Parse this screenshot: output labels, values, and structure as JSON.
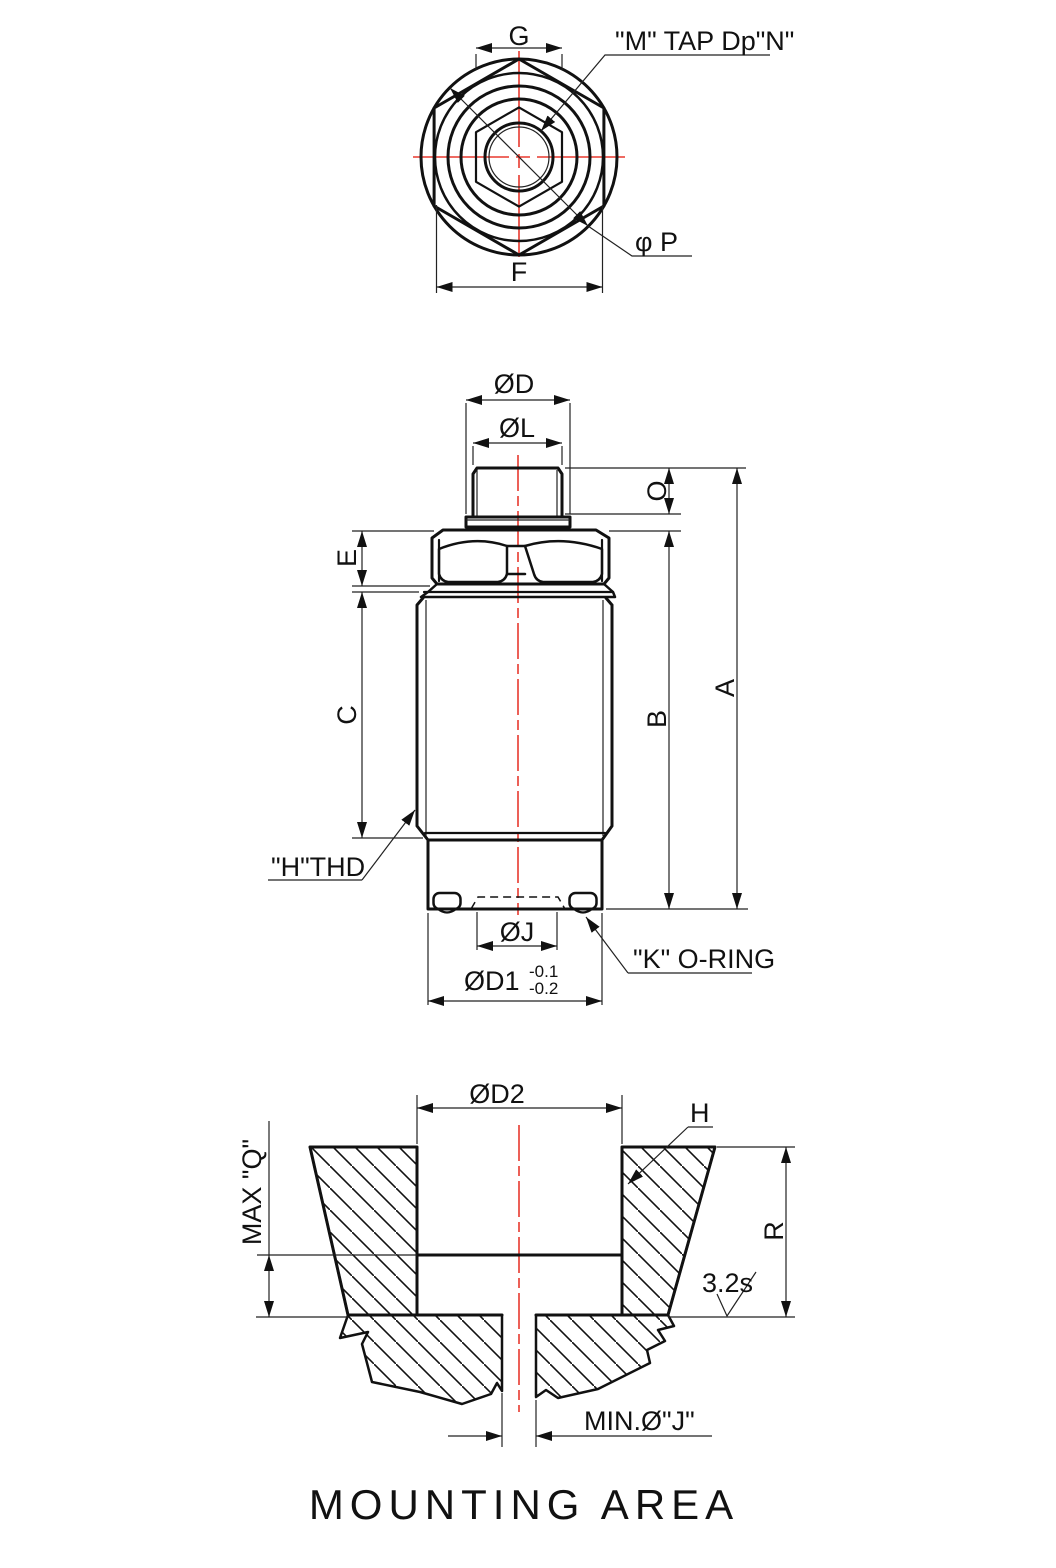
{
  "drawing": {
    "title": "MOUNTING AREA",
    "colors": {
      "line": "#111111",
      "centerline": "#e8392e"
    },
    "top_view": {
      "dim_g": "G",
      "dim_f": "F",
      "label_m_tap": "\"M\" TAP Dp\"N\"",
      "label_p": "φ P"
    },
    "front_view": {
      "dim_d": "ØD",
      "dim_l": "ØL",
      "dim_o": "O",
      "dim_e": "E",
      "dim_c": "C",
      "dim_b": "B",
      "dim_a": "A",
      "label_h_thd": "\"H\"THD",
      "dim_j": "ØJ",
      "dim_d1": "ØD1",
      "d1_tol_upper": "-0.1",
      "d1_tol_lower": "-0.2",
      "label_k_oring": "\"K\" O-RING"
    },
    "bottom_view": {
      "dim_d2": "ØD2",
      "label_h": "H",
      "dim_max_q": "MAX \"Q\"",
      "dim_r": "R",
      "surface_finish": "3.2s",
      "dim_min_j": "MIN.Ø\"J\""
    }
  }
}
